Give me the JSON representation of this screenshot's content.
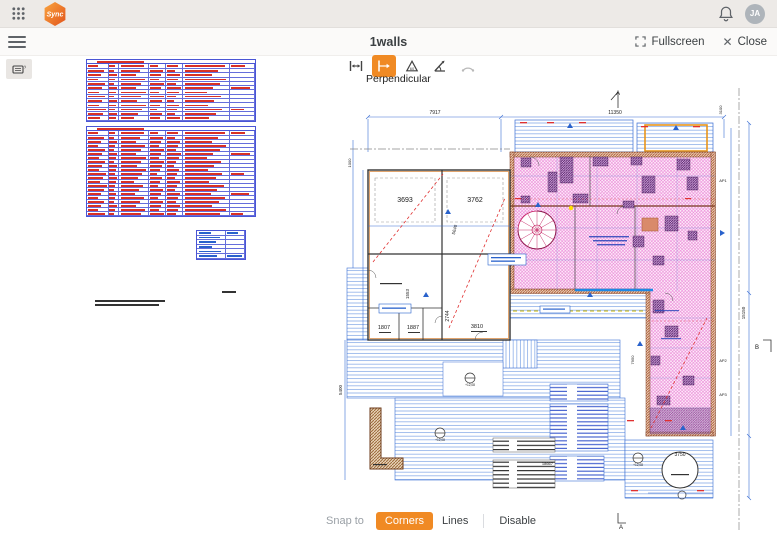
{
  "colors": {
    "accent_orange": "#F08A24",
    "table_border_blue": "#4A55D5",
    "schedule_text_red": "#D93025",
    "dimension_blue": "#2962CC",
    "hatch_pink": "#E060C8",
    "hatch_purple": "#5E2B70",
    "wall_brown": "#B4622E",
    "deck_blue": "#84A9E6"
  },
  "app_bar": {
    "logo_text": "Sync",
    "avatar_initials": "JA"
  },
  "view_header": {
    "title": "1walls",
    "fullscreen_label": "Fullscreen",
    "close_label": "Close"
  },
  "tool_panel": {
    "selected_label": "Perpendicular",
    "tools": [
      {
        "name": "distance",
        "selected": false,
        "disabled": false
      },
      {
        "name": "perpendicular",
        "selected": true,
        "disabled": false
      },
      {
        "name": "angle-triangle",
        "selected": false,
        "disabled": false
      },
      {
        "name": "angle",
        "selected": false,
        "disabled": false
      },
      {
        "name": "arc",
        "selected": false,
        "disabled": true
      }
    ]
  },
  "snap_bar": {
    "label": "Snap to",
    "options": [
      {
        "label": "Corners",
        "selected": true
      },
      {
        "label": "Lines",
        "selected": false
      },
      {
        "label": "Disable",
        "selected": false
      }
    ]
  },
  "drawing": {
    "labels": [
      {
        "text": "7917",
        "x": 100,
        "y": 36,
        "size": 5
      },
      {
        "text": "11350",
        "x": 280,
        "y": 36,
        "size": 5
      },
      {
        "text": "A",
        "x": 283,
        "y": 17,
        "size": 6
      },
      {
        "text": "A",
        "x": 286,
        "y": 451,
        "size": 6
      },
      {
        "text": "B",
        "x": 422,
        "y": 271,
        "size": 6
      },
      {
        "text": "AP1",
        "x": 388,
        "y": 104,
        "size": 4
      },
      {
        "text": "AP2",
        "x": 388,
        "y": 284,
        "size": 4
      },
      {
        "text": "AP3",
        "x": 388,
        "y": 318,
        "size": 4
      },
      {
        "text": "3693",
        "x": 70,
        "y": 124,
        "size": 7
      },
      {
        "text": "3762",
        "x": 140,
        "y": 124,
        "size": 7
      },
      {
        "text": "1807",
        "x": 49,
        "y": 251,
        "size": 5.5
      },
      {
        "text": "1887",
        "x": 78,
        "y": 251,
        "size": 5.5
      },
      {
        "text": "3810",
        "x": 142,
        "y": 250,
        "size": 5.5
      },
      {
        "text": "2744",
        "x": 114,
        "y": 238,
        "size": 5,
        "rot": -90
      },
      {
        "text": "1553",
        "x": 74,
        "y": 216,
        "size": 4.5,
        "rot": -90
      },
      {
        "text": "5640",
        "x": 121,
        "y": 152,
        "size": 4.5,
        "rot": -75
      },
      {
        "text": "5400",
        "x": 7,
        "y": 312,
        "size": 4.5,
        "rot": -90
      },
      {
        "text": "1000",
        "x": 16,
        "y": 85,
        "size": 4,
        "rot": -90
      },
      {
        "text": "3100",
        "x": 387,
        "y": 32,
        "size": 4,
        "rot": -90
      },
      {
        "text": "15150",
        "x": 410,
        "y": 235,
        "size": 4.5,
        "rot": -90
      },
      {
        "text": "7950",
        "x": 299,
        "y": 282,
        "size": 4,
        "rot": -90
      },
      {
        "text": "3750",
        "x": 345,
        "y": 378,
        "size": 5
      },
      {
        "text": "18667",
        "x": 218,
        "y": 387,
        "size": 4,
        "anchor": "end"
      },
      {
        "text": "+12,08",
        "x": 135,
        "y": 308,
        "size": 3.2
      },
      {
        "text": "+12,08",
        "x": 105,
        "y": 363,
        "size": 3.2
      },
      {
        "text": "+12,08",
        "x": 303,
        "y": 388,
        "size": 3.2
      }
    ],
    "schedule_tables": [
      {
        "id": "window-schedule",
        "x": 86,
        "y": 59,
        "w": 170,
        "rows": 12,
        "row_h": 4.3,
        "cols": [
          13,
          6,
          18,
          10,
          10,
          28,
          15
        ],
        "ink": "red",
        "title": true
      },
      {
        "id": "door-schedule",
        "x": 86,
        "y": 126,
        "w": 170,
        "rows": 20,
        "row_h": 4.0,
        "cols": [
          13,
          6,
          18,
          10,
          10,
          28,
          15
        ],
        "ink": "red",
        "title": true
      },
      {
        "id": "info-table",
        "x": 196,
        "y": 230,
        "w": 50,
        "rows": 6,
        "row_h": 4.6,
        "cols": [
          60,
          40
        ],
        "ink": "blue",
        "title": false
      }
    ],
    "note_bars": [
      {
        "x": 95,
        "y": 300,
        "w": 70,
        "lines": 2
      },
      {
        "x": 222,
        "y": 291,
        "w": 14,
        "lines": 1
      }
    ]
  }
}
